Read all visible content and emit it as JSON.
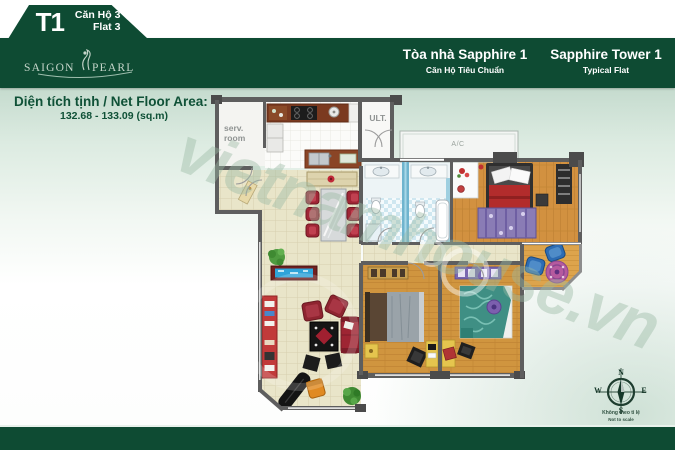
{
  "colors": {
    "brand_green": "#0e4b33",
    "mint": "#c5dbce",
    "area_text": "#0f5137",
    "wall_gray": "#5e5e5e"
  },
  "badge": {
    "code": "T1",
    "unit_vi": "Căn Hộ 3",
    "unit_en": "Flat 3"
  },
  "logo": {
    "word1": "SAIGON",
    "word2": "PEARL"
  },
  "header": {
    "title_vi": "Tòa nhà Sapphire 1",
    "subtitle_vi": "Căn Hộ Tiêu Chuẩn",
    "title_en": "Sapphire Tower 1",
    "subtitle_en": "Typical Flat"
  },
  "area": {
    "label": "Diện tích tịnh / Net Floor Area:",
    "value": "132.68 - 133.09 (sq.m)"
  },
  "plan_labels": {
    "service_room": "serv.\nroom",
    "utility": "ULT.",
    "ac": "A/C"
  },
  "compass": {
    "north": "N",
    "south": "S",
    "east": "E",
    "west": "W",
    "note_line1": "Không theo tỉ lệ",
    "note_line2": "Not to scale"
  },
  "watermark": "vietnamhouse.vn"
}
